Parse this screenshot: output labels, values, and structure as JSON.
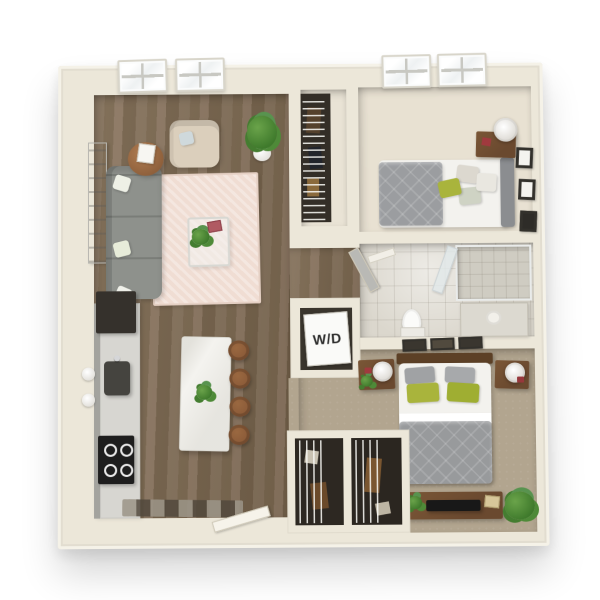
{
  "labels": {
    "washer_dryer": "W/D"
  },
  "colors": {
    "wall": "#ece7d9",
    "wall_hi": "#f5f2e8",
    "wood": "#7d6950",
    "carpet1": "#e8e1d2",
    "carpet2": "#b2a58f",
    "bath_floor": "#dbd7cd",
    "closet_dark": "#332e27",
    "rug": "#f0ddd3",
    "sofa": "#8e918c",
    "chair": "#dbcfbc",
    "island": "#f4f3ef",
    "counter": "#d7d6d1",
    "cabinet": "#a3a39e",
    "appliance": "#2a2a28",
    "stool": "#8a5a38",
    "wood_furn": "#6a492f",
    "plant": "#4d8a33",
    "duvet": "#989a9c",
    "sheet": "#f3f2ee",
    "pillow_green": "#a9b43c",
    "window": "#fbfcfc"
  }
}
